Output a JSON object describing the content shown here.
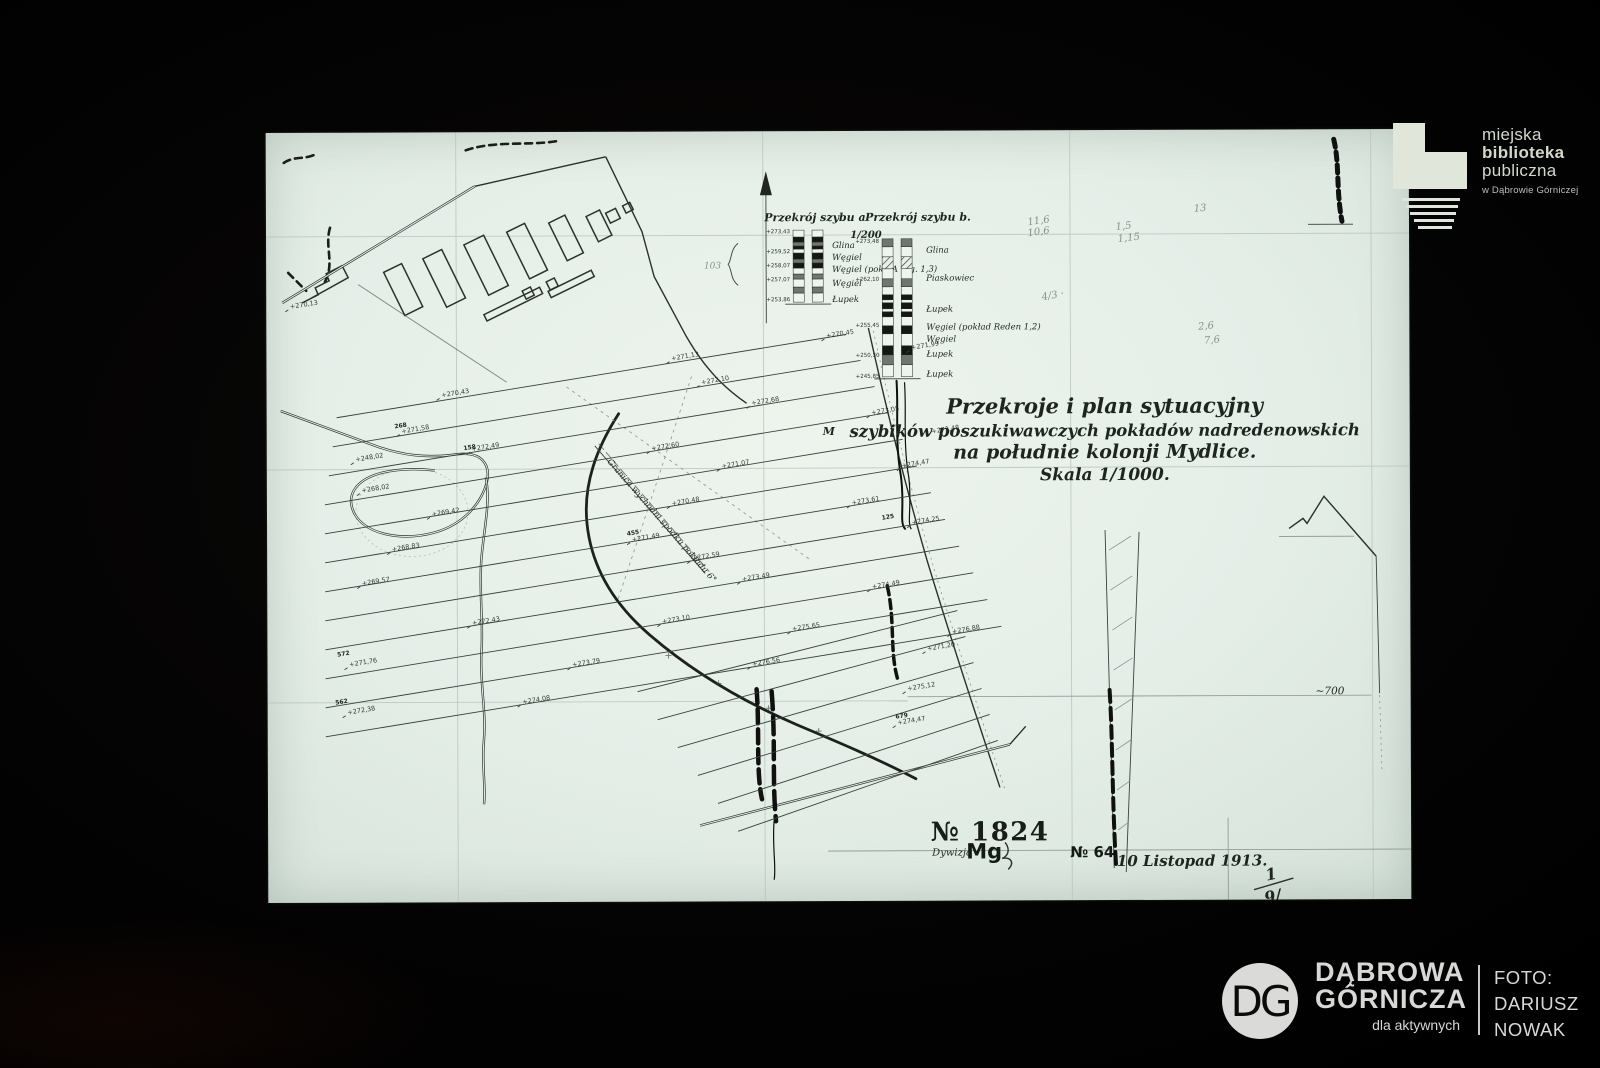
{
  "photo": {
    "background_color": "#050404",
    "sheet_color": "#e4eee7"
  },
  "map": {
    "title": {
      "line1": "Przekroje i plan sytuacyjny",
      "line2": "szybików poszukiwawczych pokładów nadredenowskich",
      "line3": "na południe kolonji Mydlice.",
      "line4": "Skala 1/1000."
    },
    "sections": {
      "scale_label": "1/200",
      "brace_label": "103",
      "a": {
        "header": "Przekrój szybu a",
        "col": {
          "x": 527,
          "top": 99,
          "strip_w": 11,
          "gap": 8,
          "segments": [
            [
              7,
              "w"
            ],
            [
              5,
              "k"
            ],
            [
              4,
              "g"
            ],
            [
              3,
              "k"
            ],
            [
              4,
              "w"
            ],
            [
              6,
              "k"
            ],
            [
              4,
              "g"
            ],
            [
              5,
              "k"
            ],
            [
              6,
              "w"
            ],
            [
              5,
              "g"
            ],
            [
              8,
              "w"
            ],
            [
              6,
              "g"
            ],
            [
              9,
              "w"
            ]
          ]
        },
        "layers": [
          "Glina",
          "Węgiel",
          "Węgiel (pokł. A w.g. 1,3)",
          "Węgiel",
          "Łupek"
        ],
        "layer_ys": [
          117,
          129,
          141,
          155,
          171
        ],
        "label_x": 566,
        "depths": [
          "+273,43",
          "+259,52",
          "+258,07",
          "+257,07",
          "+253,86"
        ],
        "depth_ys": [
          102,
          122,
          136,
          150,
          170
        ],
        "depth_x": 524
      },
      "b": {
        "header": "Przekrój szybu b.",
        "col": {
          "x": 616,
          "top": 108,
          "strip_w": 11,
          "gap": 8,
          "segments": [
            [
              8,
              "g"
            ],
            [
              10,
              "w"
            ],
            [
              12,
              "h"
            ],
            [
              10,
              "w"
            ],
            [
              8,
              "g"
            ],
            [
              8,
              "w"
            ],
            [
              5,
              "k"
            ],
            [
              3,
              "w"
            ],
            [
              6,
              "k"
            ],
            [
              3,
              "w"
            ],
            [
              5,
              "k"
            ],
            [
              9,
              "w"
            ],
            [
              8,
              "k"
            ],
            [
              12,
              "w"
            ],
            [
              9,
              "k"
            ],
            [
              10,
              "g"
            ],
            [
              12,
              "w"
            ]
          ]
        },
        "layers": [
          "Glina",
          "Piaskowiec",
          "Łupek",
          "Węgiel (pokład Reden 1,2)",
          "Węgiel",
          "Łupek",
          "Łupek"
        ],
        "layer_ys": [
          122,
          150,
          181,
          199,
          211,
          226,
          246
        ],
        "label_x": 660,
        "depths": [
          "+273,48",
          "+262,10",
          "+255,45",
          "+250,30",
          "+245,85"
        ],
        "depth_ys": [
          112,
          150,
          196,
          226,
          247
        ],
        "depth_x": 613
      }
    },
    "annotations": {
      "plan_number": "№ 1824",
      "division_label": "Dywizja",
      "division_value": "Mg",
      "sheet_number": "№ 64",
      "date": "10 Listopad 1913.",
      "fraction_top": "1",
      "fraction_bottom": "9/",
      "depth_700": "~700",
      "granica_note": "Granica wychodni spodku pokładu 6°",
      "letter_m": "M"
    },
    "spot_heights": [
      [
        175,
        265,
        "+270,43"
      ],
      [
        405,
        229,
        "+271,13"
      ],
      [
        560,
        207,
        "+270,45"
      ],
      [
        135,
        301,
        "+271,58"
      ],
      [
        435,
        253,
        "+272,10"
      ],
      [
        645,
        219,
        "+271,99"
      ],
      [
        205,
        319,
        "+272,49"
      ],
      [
        485,
        274,
        "+272,68"
      ],
      [
        95,
        360,
        "+268,02"
      ],
      [
        385,
        319,
        "+272,60"
      ],
      [
        605,
        284,
        "+273,05"
      ],
      [
        165,
        384,
        "+269,42"
      ],
      [
        455,
        337,
        "+271,07"
      ],
      [
        665,
        303,
        "+273,48"
      ],
      [
        125,
        419,
        "+268,83"
      ],
      [
        405,
        374,
        "+270,48"
      ],
      [
        635,
        337,
        "+274,47"
      ],
      [
        95,
        453,
        "+269,57"
      ],
      [
        365,
        410,
        "+271,49"
      ],
      [
        585,
        374,
        "+273,61"
      ],
      [
        82,
        534,
        "+271,76"
      ],
      [
        425,
        429,
        "+272,59"
      ],
      [
        645,
        394,
        "+274,25"
      ],
      [
        205,
        493,
        "+272,43"
      ],
      [
        475,
        450,
        "+273,49"
      ],
      [
        80,
        582,
        "+272,38"
      ],
      [
        395,
        492,
        "+273,10"
      ],
      [
        605,
        458,
        "+274,49"
      ],
      [
        305,
        535,
        "+273,79"
      ],
      [
        525,
        500,
        "+275,65"
      ],
      [
        255,
        572,
        "+274,08"
      ],
      [
        485,
        535,
        "+276,56"
      ],
      [
        685,
        503,
        "+276,88"
      ],
      [
        630,
        594,
        "+274,47"
      ],
      [
        660,
        520,
        "+271,20"
      ],
      [
        640,
        560,
        "+275,12"
      ],
      [
        24,
        176,
        "+270,13"
      ],
      [
        89,
        329,
        "+248,02"
      ]
    ],
    "station_numbers": [
      [
        70,
        524,
        "572"
      ],
      [
        68,
        572,
        "562"
      ],
      [
        128,
        296,
        "268"
      ],
      [
        197,
        318,
        "158"
      ],
      [
        360,
        404,
        "455"
      ],
      [
        615,
        389,
        "125"
      ],
      [
        628,
        588,
        "679"
      ]
    ],
    "faint_notes": [
      [
        762,
        95,
        "11,6",
        -8
      ],
      [
        762,
        106,
        "10,6",
        -8
      ],
      [
        850,
        100,
        "1,5",
        -6
      ],
      [
        852,
        112,
        "1,15",
        -6
      ],
      [
        928,
        82,
        "13",
        -4
      ],
      [
        776,
        170,
        "4/3 ·",
        -10
      ],
      [
        932,
        200,
        "2,6",
        -5
      ],
      [
        938,
        214,
        "7,6",
        -5
      ]
    ]
  },
  "overlays": {
    "library_logo": {
      "line1": "miejska",
      "line2": "biblioteka",
      "line3": "publiczna",
      "line4": "w Dąbrowie Górniczej"
    },
    "city_logo": {
      "monogram": "DG",
      "name_line1": "DĄBROWA",
      "name_line2": "GÓRNICZA",
      "tagline": "dla aktywnych",
      "credit_line1": "FOTO:",
      "credit_line2": "DARIUSZ",
      "credit_line3": "NOWAK"
    }
  }
}
